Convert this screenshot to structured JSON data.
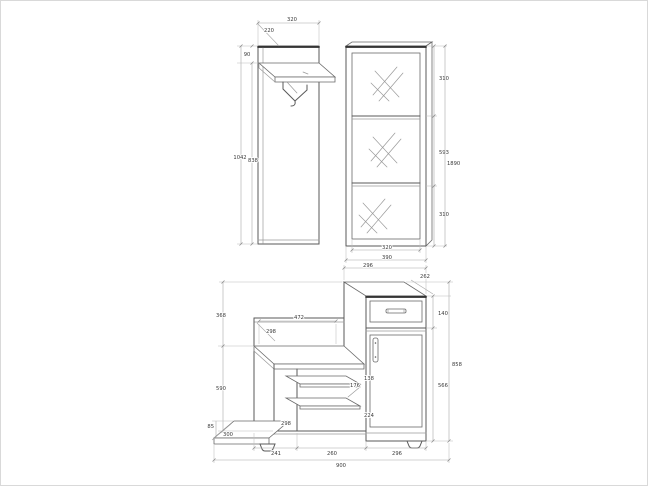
{
  "page": {
    "background": "#ffffff",
    "line_color": "#5a5a5a",
    "dim_text_color": "#3a3a3a"
  },
  "panel": {
    "description": "wall panel with shelf and coat hook",
    "width": "320",
    "shelf_depth": "220",
    "top_offset": "90",
    "height_total": "1042",
    "height_under_shelf": "838"
  },
  "cabinet": {
    "description": "tall cabinet with glass door",
    "section_top": "310",
    "section_middle": "593",
    "section_bottom": "310",
    "height_total": "1890",
    "door_width": "320",
    "width": "390"
  },
  "chest": {
    "description": "hall bench cabinet with drawer and door",
    "column_width_top": "296",
    "depth": "262",
    "drawer_height": "140",
    "door_section_height": "566",
    "height_total": "858",
    "upper_left_height": "368",
    "lower_left_height": "590",
    "plinth_height": "85",
    "plinth_depth": "300",
    "seat_width": "472",
    "seat_depth": "298",
    "shelf_gap_top": "138",
    "shelf_gap_middle": "176",
    "shelf_gap_bottom": "224",
    "niche_width": "298",
    "bottom_width_left": "241",
    "bottom_width_middle": "260",
    "bottom_width_right": "296",
    "total_width": "900"
  }
}
